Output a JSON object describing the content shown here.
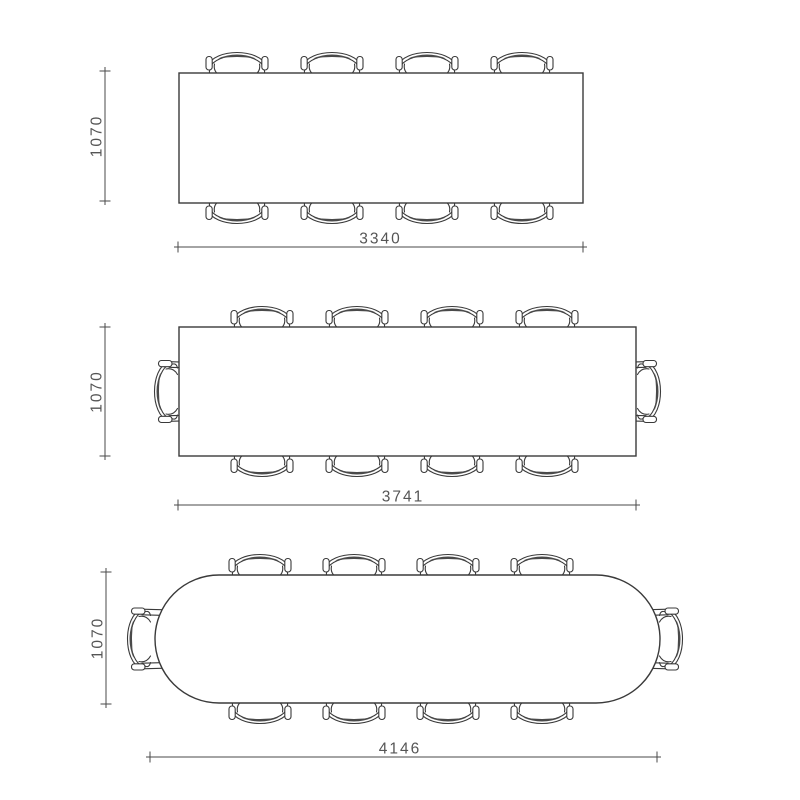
{
  "diagram": {
    "type": "furniture-top-view-dimension-drawing",
    "colors": {
      "background": "#ffffff",
      "surface": "#ffffff",
      "line": "#3a3a3a",
      "dim": "#4a4a4a",
      "text": "#555555"
    },
    "views": [
      {
        "id": "rectangular-table-8-seats",
        "shape": "rectangular",
        "seats": 8,
        "chairs_long_side": 4,
        "chairs_ends": 0,
        "height_mm": "1070",
        "width_mm": "3340"
      },
      {
        "id": "rectangular-table-10-seats",
        "shape": "rectangular",
        "seats": 10,
        "chairs_long_side": 4,
        "chairs_ends": 2,
        "height_mm": "1070",
        "width_mm": "3741"
      },
      {
        "id": "rounded-table-10-seats",
        "shape": "stadium",
        "seats": 10,
        "chairs_long_side": 4,
        "chairs_ends": 2,
        "height_mm": "1070",
        "width_mm": "4146"
      }
    ]
  }
}
